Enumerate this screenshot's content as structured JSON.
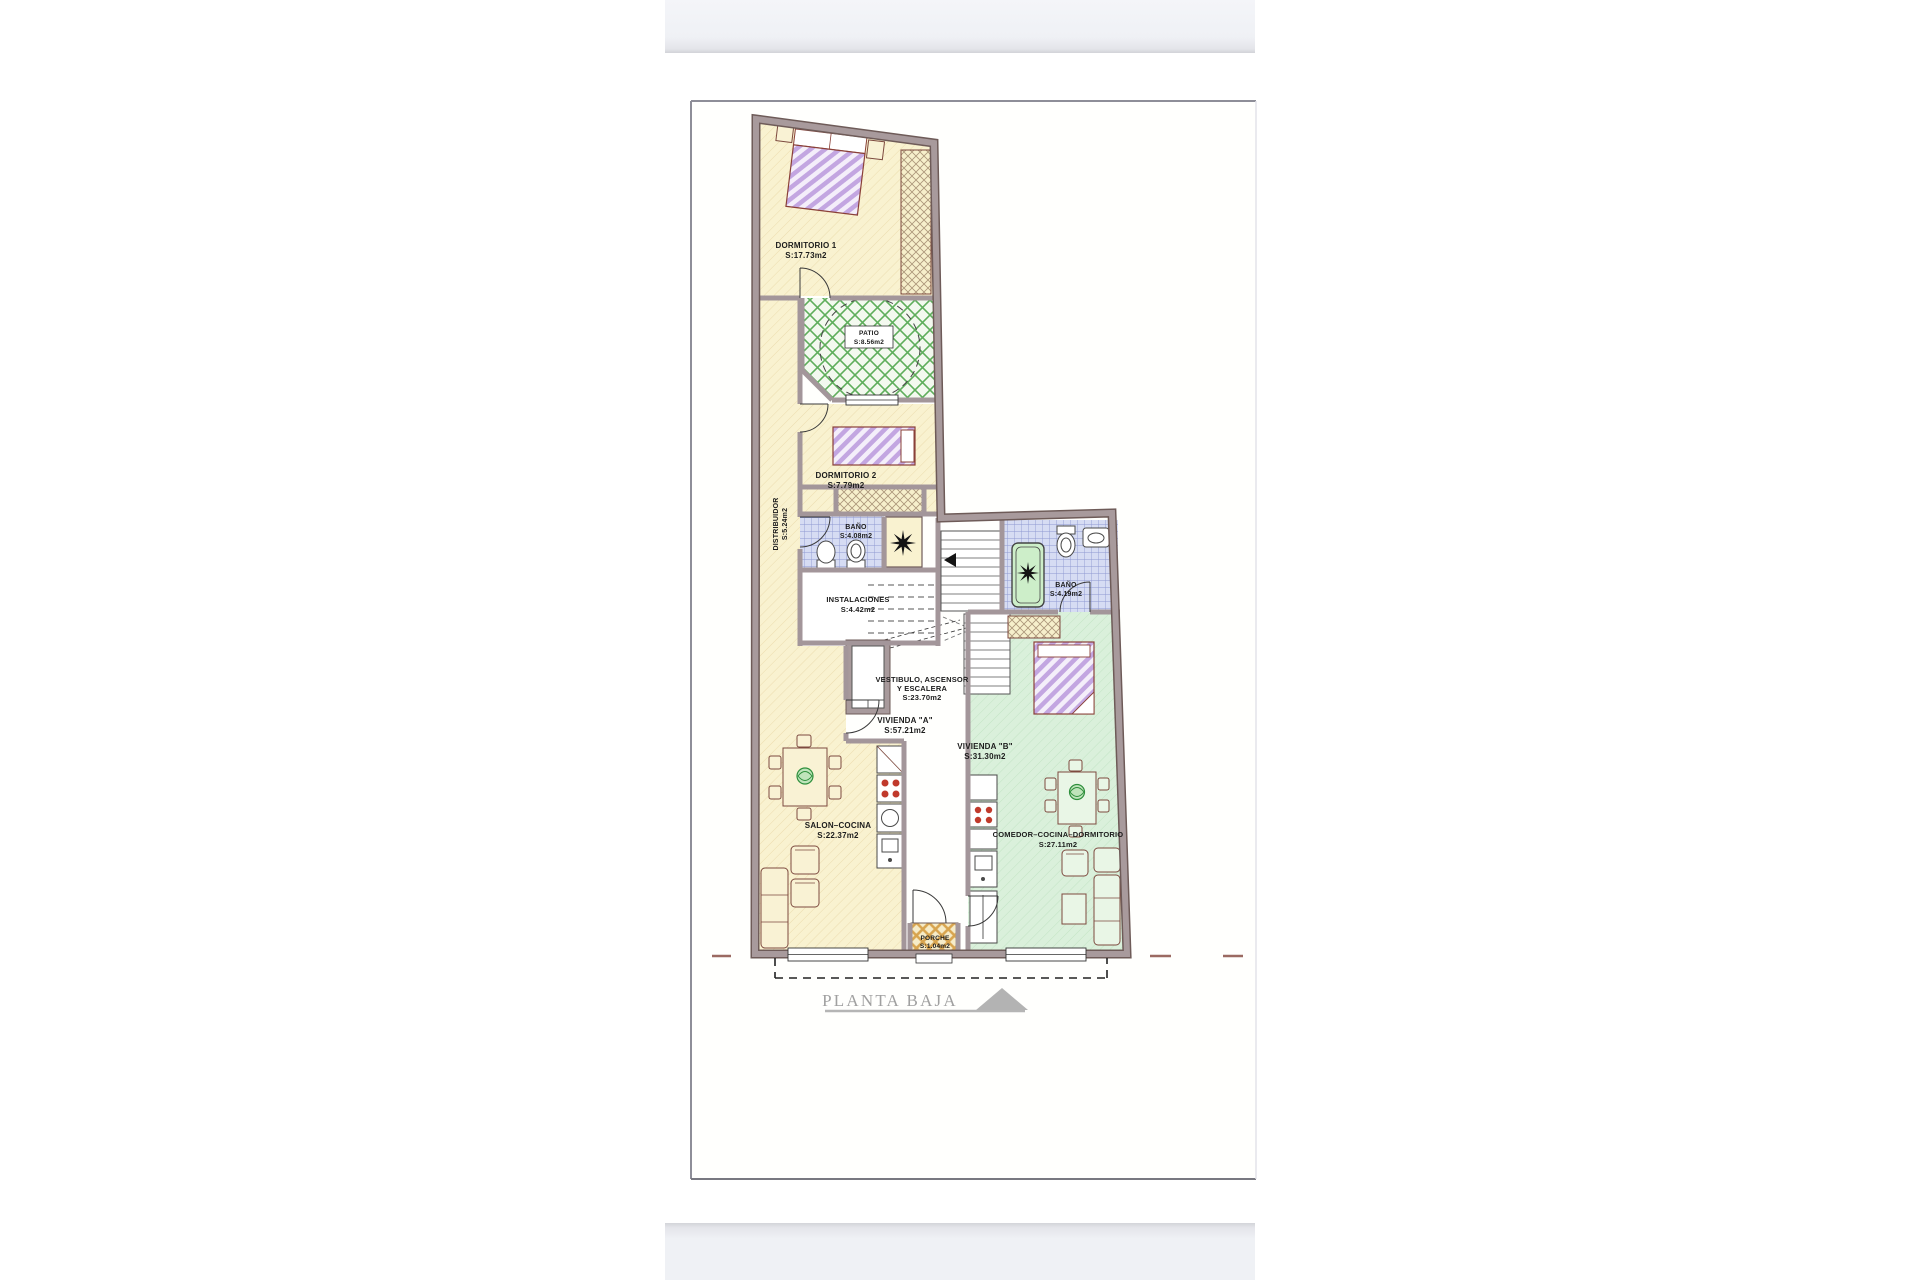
{
  "plan": {
    "title": "PLANTA BAJA",
    "rooms": {
      "dormitorio_1": {
        "name": "DORMITORIO 1",
        "area": "S:17.73m2"
      },
      "patio": {
        "name": "PATIO",
        "area": "S:8.56m2"
      },
      "dormitorio_2": {
        "name": "DORMITORIO 2",
        "area": "S:7.79m2"
      },
      "distribuidor": {
        "name": "DISTRIBUIDOR",
        "area": "S:5.24m2"
      },
      "bano_a": {
        "name": "BAÑO",
        "area": "S:4.08m2"
      },
      "instalaciones": {
        "name": "INSTALACIONES",
        "area": "S:4.42m2"
      },
      "bano_b": {
        "name": "BAÑO",
        "area": "S:4.19m2"
      },
      "vestibulo": {
        "name_line1": "VESTIBULO, ASCENSOR",
        "name_line2": "Y ESCALERA",
        "area": "S:23.70m2"
      },
      "vivienda_a": {
        "name": "VIVIENDA  \"A\"",
        "area": "S:57.21m2"
      },
      "vivienda_b": {
        "name": "VIVIENDA  \"B\"",
        "area": "S:31.30m2"
      },
      "salon_cocina": {
        "name": "SALON–COCINA",
        "area": "S:22.37m2"
      },
      "comedor": {
        "name": "COMEDOR–COCINA–DORMITORIO",
        "area": "S:27.11m2"
      },
      "porche": {
        "name": "PORCHE",
        "area": "S:1.04m2"
      }
    },
    "colors": {
      "wall": "#a3969a",
      "room_cream": "#f9f2d0",
      "vivienda_b_green": "#daf0db",
      "patio_green": "#5fae5c",
      "bath_tile": "#d6dcf3",
      "bed_stripe": "#c3a6e1",
      "boundary_red": "#9b6a62",
      "title_grey": "#a0a0a0"
    }
  }
}
